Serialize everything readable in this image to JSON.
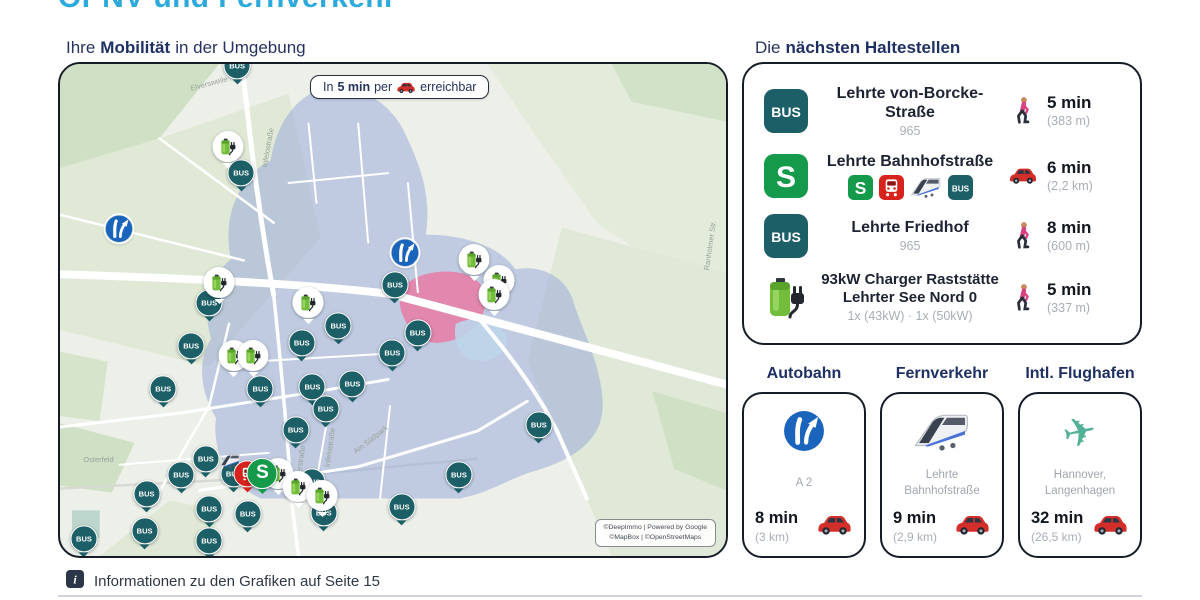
{
  "page": {
    "title": "ÖPNV und Fernverkehr",
    "footer_note": "Informationen zu den Grafiken auf Seite 15"
  },
  "colors": {
    "accent_cyan": "#2baadb",
    "heading_navy": "#1f3063",
    "bus_teal": "#1d5f66",
    "sbahn_green": "#149a4a",
    "regional_red": "#d6231e",
    "car_red": "#d32f2a",
    "charger_green": "#72bd3c",
    "motorway_blue": "#1a64bc",
    "isochrone_blue": "#93a5db",
    "zone_pink": "#e87ba3"
  },
  "map_section": {
    "heading_prefix": "Ihre",
    "heading_bold": "Mobilität",
    "heading_suffix": "in der Umgebung",
    "legend_prefix": "In",
    "legend_bold": "5 min",
    "legend_mid": "per",
    "legend_icon": "car-icon",
    "legend_suffix": "erreichbar",
    "attribution_line1": "©DeepImmo | Powered by Google",
    "attribution_line2": "©MapBox | ©OpenStreetMaps",
    "street_labels": [
      {
        "text": "Elversweile",
        "x": 19.5,
        "y": 3.0,
        "rot": -15
      },
      {
        "text": "Infelostraße",
        "x": 28.2,
        "y": 16.0,
        "rot": -80
      },
      {
        "text": "Ranholmer Str.",
        "x": 93.8,
        "y": 36.0,
        "rot": -82
      },
      {
        "text": "Am Südpark",
        "x": 43.5,
        "y": 75.5,
        "rot": -38
      },
      {
        "text": "Osterfeld",
        "x": 3.5,
        "y": 79.5,
        "rot": 0
      },
      {
        "text": "Elerstraße",
        "x": 33.5,
        "y": 80.0,
        "rot": -82
      },
      {
        "text": "Infelostraße",
        "x": 37.6,
        "y": 77.0,
        "rot": -82
      }
    ],
    "markers": [
      {
        "type": "bus",
        "x": 26.6,
        "y": 0.8
      },
      {
        "type": "bus",
        "x": 27.2,
        "y": 22.6
      },
      {
        "type": "bus",
        "x": 22.4,
        "y": 49.0
      },
      {
        "type": "bus",
        "x": 19.7,
        "y": 57.7
      },
      {
        "type": "bus",
        "x": 15.5,
        "y": 66.5
      },
      {
        "type": "bus",
        "x": 36.3,
        "y": 57.1
      },
      {
        "type": "bus",
        "x": 41.8,
        "y": 53.6
      },
      {
        "type": "bus",
        "x": 50.3,
        "y": 45.4
      },
      {
        "type": "bus",
        "x": 53.7,
        "y": 55.0
      },
      {
        "type": "bus",
        "x": 49.9,
        "y": 59.1
      },
      {
        "type": "bus",
        "x": 30.1,
        "y": 66.5
      },
      {
        "type": "bus",
        "x": 37.9,
        "y": 66.1
      },
      {
        "type": "bus",
        "x": 43.9,
        "y": 65.5
      },
      {
        "type": "bus",
        "x": 39.9,
        "y": 70.6
      },
      {
        "type": "bus",
        "x": 35.4,
        "y": 74.8
      },
      {
        "type": "bus",
        "x": 71.9,
        "y": 73.8
      },
      {
        "type": "bus",
        "x": 59.9,
        "y": 83.9
      },
      {
        "type": "bus",
        "x": 51.3,
        "y": 90.5
      },
      {
        "type": "bus",
        "x": 3.6,
        "y": 97.0
      },
      {
        "type": "bus",
        "x": 12.7,
        "y": 95.4
      },
      {
        "type": "bus",
        "x": 13.0,
        "y": 87.9
      },
      {
        "type": "bus",
        "x": 18.2,
        "y": 83.9
      },
      {
        "type": "bus",
        "x": 21.9,
        "y": 80.6
      },
      {
        "type": "bus",
        "x": 22.4,
        "y": 90.9
      },
      {
        "type": "bus",
        "x": 26.1,
        "y": 83.7
      },
      {
        "type": "bus",
        "x": 28.2,
        "y": 91.9
      },
      {
        "type": "bus",
        "x": 39.6,
        "y": 91.7
      },
      {
        "type": "bus",
        "x": 37.9,
        "y": 85.3
      },
      {
        "type": "bus",
        "x": 22.4,
        "y": 97.4
      },
      {
        "type": "charger",
        "x": 25.2,
        "y": 17.3
      },
      {
        "type": "charger",
        "x": 23.9,
        "y": 45.0
      },
      {
        "type": "charger",
        "x": 37.3,
        "y": 49.0
      },
      {
        "type": "charger",
        "x": 26.1,
        "y": 59.7
      },
      {
        "type": "charger",
        "x": 29.0,
        "y": 59.7
      },
      {
        "type": "charger",
        "x": 62.2,
        "y": 40.3
      },
      {
        "type": "charger",
        "x": 65.9,
        "y": 44.6
      },
      {
        "type": "charger",
        "x": 65.2,
        "y": 47.4
      },
      {
        "type": "charger",
        "x": 32.8,
        "y": 83.7
      },
      {
        "type": "charger",
        "x": 35.8,
        "y": 86.3
      },
      {
        "type": "charger",
        "x": 39.4,
        "y": 88.3
      },
      {
        "type": "motorway",
        "x": 8.8,
        "y": 33.9
      },
      {
        "type": "motorway",
        "x": 51.8,
        "y": 38.9
      },
      {
        "type": "ice",
        "x": 25.6,
        "y": 80.9
      },
      {
        "type": "regional",
        "x": 28.1,
        "y": 83.7
      },
      {
        "type": "sbahn",
        "x": 30.4,
        "y": 83.7
      }
    ]
  },
  "stops_section": {
    "heading_prefix": "Die",
    "heading_bold": "nächsten Haltestellen",
    "stops": [
      {
        "icon": "bus-badge",
        "name_lines": [
          "Lehrte von-Borcke-Straße"
        ],
        "sub": "965",
        "eta_icon": "walk-icon",
        "time": "5 min",
        "dist": "(383 m)"
      },
      {
        "icon": "sbahn-badge",
        "name_lines": [
          "Lehrte Bahnhofstraße"
        ],
        "mode_icons": [
          "sbahn-mini",
          "regional-mini",
          "ice-mini",
          "bus-mini"
        ],
        "eta_icon": "car-icon",
        "time": "6 min",
        "dist": "(2,2 km)"
      },
      {
        "icon": "bus-badge",
        "name_lines": [
          "Lehrte Friedhof"
        ],
        "sub": "965",
        "eta_icon": "walk-icon",
        "time": "8 min",
        "dist": "(600 m)"
      },
      {
        "icon": "charger-icon",
        "name_lines": [
          "93kW Charger Raststätte",
          "Lehrter See Nord 0"
        ],
        "sub": "1x (43kW) · 1x (50kW)",
        "eta_icon": "walk-icon",
        "time": "5 min",
        "dist": "(337 m)"
      }
    ]
  },
  "travel_cards": [
    {
      "heading": "Autobahn",
      "icon": "motorway-icon",
      "label_lines": [
        "A 2"
      ],
      "time": "8 min",
      "dist": "(3 km)"
    },
    {
      "heading": "Fernverkehr",
      "icon": "ice-train-icon",
      "label_lines": [
        "Lehrte Bahnhofstraße"
      ],
      "time": "9 min",
      "dist": "(2,9 km)"
    },
    {
      "heading": "Intl. Flughafen",
      "icon": "airplane-icon",
      "label_lines": [
        "Hannover,",
        "Langenhagen"
      ],
      "time": "32 min",
      "dist": "(26,5 km)"
    }
  ]
}
